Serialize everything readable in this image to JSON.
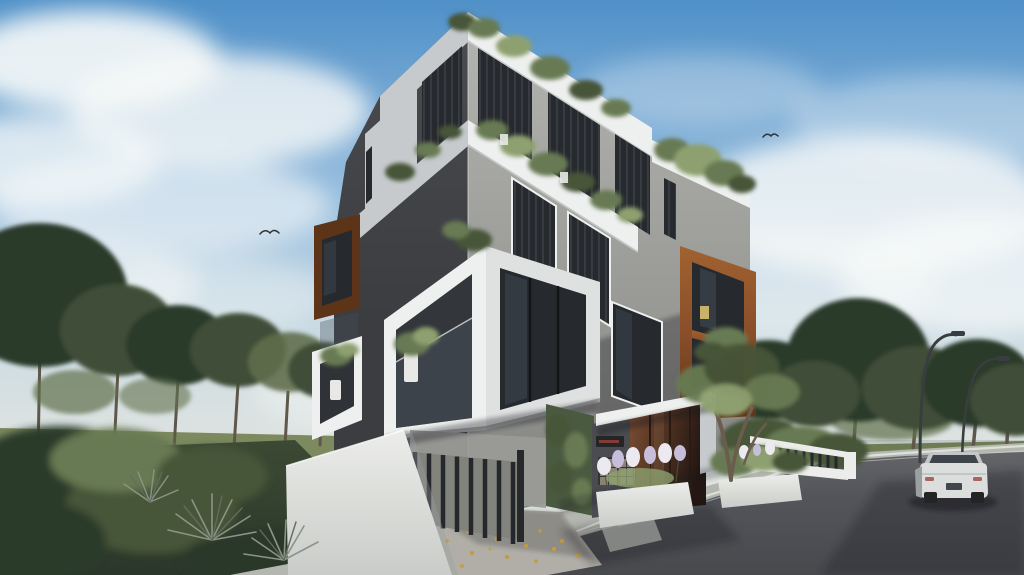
{
  "meta": {
    "title": "Exterior 3D rendering of a modern apartment building on a street corner, daytime",
    "image_type": "architectural-render",
    "visible_text": "none legible (small red building sign beside entrance, blurred)"
  },
  "scene": {
    "building": {
      "style": "contemporary cubic apartment block, corner perspective",
      "floors_visible": 4,
      "features": [
        "white wrap-around frame bands",
        "projecting white box balconies",
        "dark vertical-louver glazing",
        "corten-steel box window frames",
        "rooftop and balcony planting",
        "glass balustrades",
        "recessed dark ground floor"
      ]
    },
    "entrance": {
      "door": "glossy dark timber entrance doors",
      "canopy": "thin white slab canopy",
      "sign": {
        "legible": false,
        "text_color_hint": "dark red"
      },
      "mailboxes": {
        "rows": 3,
        "cols": 4
      }
    },
    "site": [
      "white boundary walls",
      "dark vertical-slat driveway gate",
      "concrete driveway with scattered fallen leaves",
      "white flower planters",
      "green ivy wall panel",
      "yucca plants",
      "lawn and shrubs",
      "mature trees left and right"
    ],
    "street": {
      "road": "asphalt road across bottom right",
      "sidewalk": "light concrete sidewalk with white curb line",
      "car": {
        "description": "white sedan seen from behind",
        "count": 1
      },
      "street_lamps": 2,
      "birds": 2,
      "horizon": "pale sea/sky strip at right"
    }
  },
  "palette": {
    "sky_top": "#4f90c8",
    "sky_mid": "#9ec2e0",
    "sky_low": "#cfdde2",
    "sky_horizon": "#e2e4e0",
    "cloud": "#f7f9f8",
    "sea": "#bcc6c6",
    "field": "#7d8a5f",
    "field_dark": "#6e7c54",
    "tree": "#3f4e38",
    "tree_dark": "#2c3a2b",
    "tree_light": "#5f6f4c",
    "trunk": "#5f584a",
    "grass": "#3c4a34",
    "grass_dark": "#2a372a",
    "road": "#53555a",
    "road_far": "#636569",
    "road_near": "#47494d",
    "sidewalk": "#b4b6b0",
    "curb": "#e2e4df",
    "driveway": "#b0aea6",
    "leaves": "#c59a3a",
    "facade_light": "#9a9b97",
    "facade_light_top": "#b4b5b1",
    "facade_light_low": "#82837f",
    "facade_dark": "#3b3d41",
    "facade_dark_top": "#4a4c50",
    "white_band": "#eef0ef",
    "white_band_shade": "#c6cacd",
    "glass": "#26292d",
    "glass_line": "#3d4248",
    "frame": "#131517",
    "reflect": "#46505a",
    "corten": "#8a4e2a",
    "corten_light": "#a0622f",
    "corten_dark": "#5e3419",
    "plant": "#687a52",
    "plant_dark": "#475439",
    "plant_light": "#8ea06f",
    "ivy": "#4a5a40",
    "wall_white": "#ecedea",
    "wall_shade": "#c9ccc8",
    "fence": "#26292c",
    "gate_bar": "#24272b",
    "gate_back": "#83837d",
    "flower": "#eceaf0",
    "flower2": "#c7bedb",
    "pot": "#e8e9e6",
    "door_light": "#7c4e33",
    "door_dark": "#241712",
    "sign_plaque": "#232526",
    "sign_red": "#93413a",
    "mail_panel": "#323437",
    "mail_cell": "#958b7c",
    "car_body": "#dcdedd",
    "car_top": "#c2c6c7",
    "car_shade": "#9aa0a2",
    "car_glass": "#3f444a",
    "tire": "#222426",
    "tail": "#a05a4c",
    "plate": "#43464a",
    "lamp": "#3a3d40",
    "bird": "#2e3236",
    "shadow": "#15181b",
    "step": "#c7c9c3",
    "yucca": "#8b9486",
    "yucca_dark": "#626c5e"
  }
}
